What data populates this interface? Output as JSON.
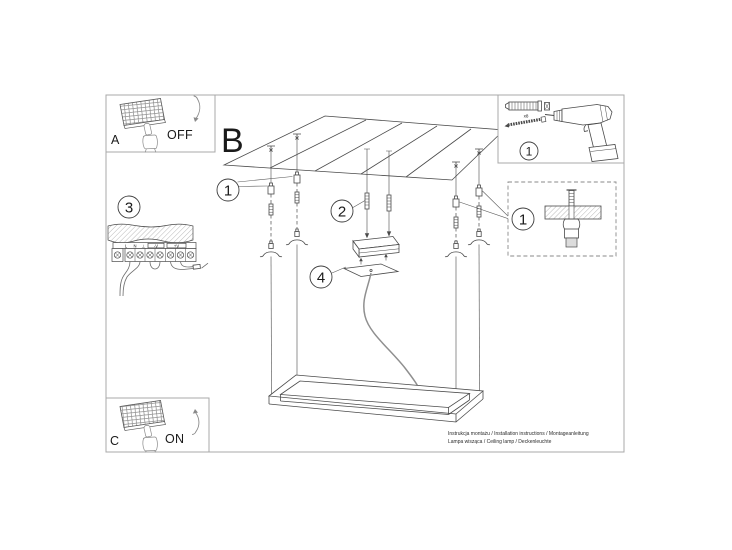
{
  "document_kind": "ceiling-lamp-installation-manual",
  "panels": {
    "a": {
      "label": "A",
      "state": "OFF"
    },
    "c": {
      "label": "C",
      "state": "ON"
    }
  },
  "section": {
    "label": "B"
  },
  "callouts": {
    "wiring_step": "3",
    "fixing": "1",
    "rod": "2",
    "canopy": "4",
    "tools": "1",
    "anchor_detail": "1"
  },
  "hardware": {
    "anchor_qty": "x8"
  },
  "wiring_labels": {
    "l": "L",
    "n": "N",
    "earth": "⊥",
    "minus_v": "-V",
    "plus_v": "+V"
  },
  "footer": {
    "line1": "Instrukcja montażu / Installation instructions / Montageanleitung",
    "line2": "Lampa wisząca / Ceiling lamp / Deckenleuchte"
  },
  "colors": {
    "background": "#ffffff",
    "line": "#4a4a4a",
    "frame": "#a8a8a8",
    "light_line": "#8a8a8a",
    "text": "#1a1a1a"
  }
}
